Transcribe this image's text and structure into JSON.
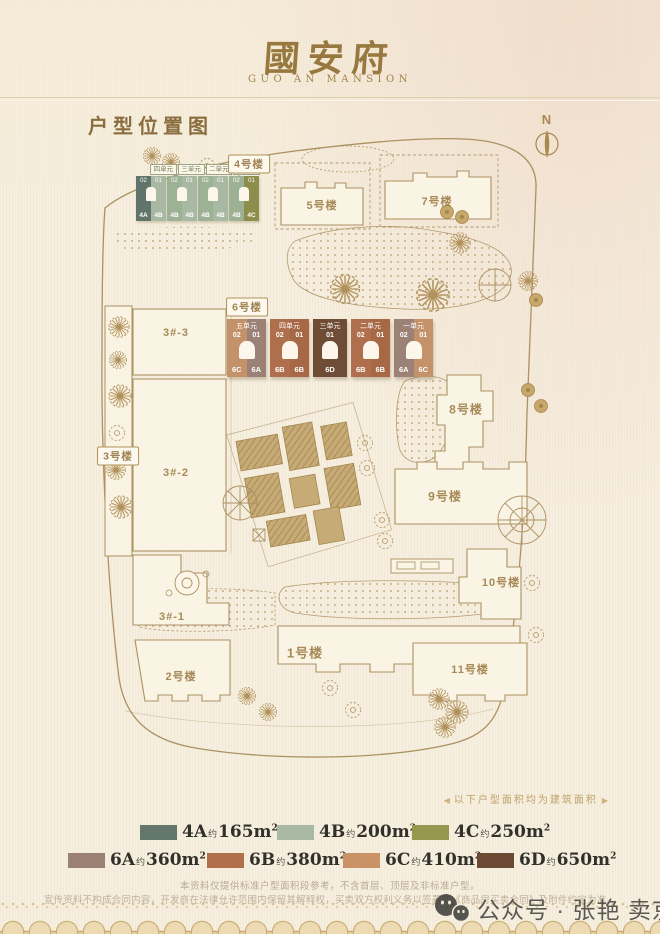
{
  "header": {
    "logo_cn": "國安府",
    "logo_en": "GUO AN MANSION"
  },
  "page_title": "户型位置图",
  "compass_label": "N",
  "map": {
    "labels": {
      "b4": "4号楼",
      "b5": "5号楼",
      "b7": "7号楼",
      "b6": "6号楼",
      "b3_3": "3#-3",
      "b3_2": "3#-2",
      "b3_1": "3#-1",
      "b3": "3号楼",
      "b2": "2号楼",
      "b1": "1号楼",
      "b8": "8号楼",
      "b9": "9号楼",
      "b10": "10号楼",
      "b11": "11号楼"
    },
    "bld4": {
      "units": [
        {
          "name": "四单元",
          "cells": [
            {
              "no": "02",
              "type": "4A",
              "color": "#61746b"
            },
            {
              "no": "01",
              "type": "4B",
              "color": "#a9b8a3"
            }
          ]
        },
        {
          "name": "三单元",
          "cells": [
            {
              "no": "02",
              "type": "4B",
              "color": "#9db195"
            },
            {
              "no": "01",
              "type": "4B",
              "color": "#a9b8a3"
            }
          ]
        },
        {
          "name": "二单元",
          "cells": [
            {
              "no": "02",
              "type": "4B",
              "color": "#9db195"
            },
            {
              "no": "01",
              "type": "4B",
              "color": "#a9b8a3"
            }
          ]
        },
        {
          "name": "一单元",
          "cells": [
            {
              "no": "02",
              "type": "4B",
              "color": "#9db195"
            },
            {
              "no": "01",
              "type": "4C",
              "color": "#8d8d4c"
            }
          ]
        }
      ]
    },
    "bld6": {
      "units": [
        {
          "name": "五单元",
          "cells": [
            {
              "no": "02",
              "type": "6C",
              "color": "#c3916a"
            },
            {
              "no": "01",
              "type": "6A",
              "color": "#9b8176"
            }
          ]
        },
        {
          "name": "四单元",
          "cells": [
            {
              "no": "02",
              "type": "6B",
              "color": "#b06f4c"
            },
            {
              "no": "01",
              "type": "6B",
              "color": "#a76845"
            }
          ]
        },
        {
          "name": "三单元",
          "cells": [
            {
              "no": "01",
              "type": "6D",
              "color": "#6e4c36"
            }
          ]
        },
        {
          "name": "二单元",
          "cells": [
            {
              "no": "02",
              "type": "6B",
              "color": "#b06f4c"
            },
            {
              "no": "01",
              "type": "6B",
              "color": "#a76845"
            }
          ]
        },
        {
          "name": "一单元",
          "cells": [
            {
              "no": "02",
              "type": "6A",
              "color": "#9b8176"
            },
            {
              "no": "01",
              "type": "6C",
              "color": "#c3916a"
            }
          ]
        }
      ]
    }
  },
  "area_note": {
    "left": "◀",
    "text": "以下户型面积均为建筑面积",
    "right": "▶"
  },
  "legend": {
    "row1": [
      {
        "code": "4A",
        "approx": "约",
        "area": "165m",
        "sup": "2",
        "color": "#64776c"
      },
      {
        "code": "4B",
        "approx": "约",
        "area": "200m",
        "sup": "2",
        "color": "#a9b8a3"
      },
      {
        "code": "4C",
        "approx": "约",
        "area": "250m",
        "sup": "2",
        "color": "#97984f"
      }
    ],
    "row2": [
      {
        "code": "6A",
        "approx": "约",
        "area": "360m",
        "sup": "2",
        "color": "#9b8173"
      },
      {
        "code": "6B",
        "approx": "约",
        "area": "380m",
        "sup": "2",
        "color": "#b26f4c"
      },
      {
        "code": "6C",
        "approx": "约",
        "area": "410m",
        "sup": "2",
        "color": "#c99367"
      },
      {
        "code": "6D",
        "approx": "约",
        "area": "650m",
        "sup": "2",
        "color": "#6b4933"
      }
    ]
  },
  "disclaimer": {
    "line1": "本资料仅提供标准户型面积段参考，不含首层、顶层及非标准户型。",
    "line2": "宣传资料不构成合同内容，开发商在法律允许范围内保留其解释权，买卖双方权利义务以签署的《商品房买卖合同》及附件约定为准。"
  },
  "watermark": {
    "text": "公众号 · 张艳 卖京房"
  }
}
